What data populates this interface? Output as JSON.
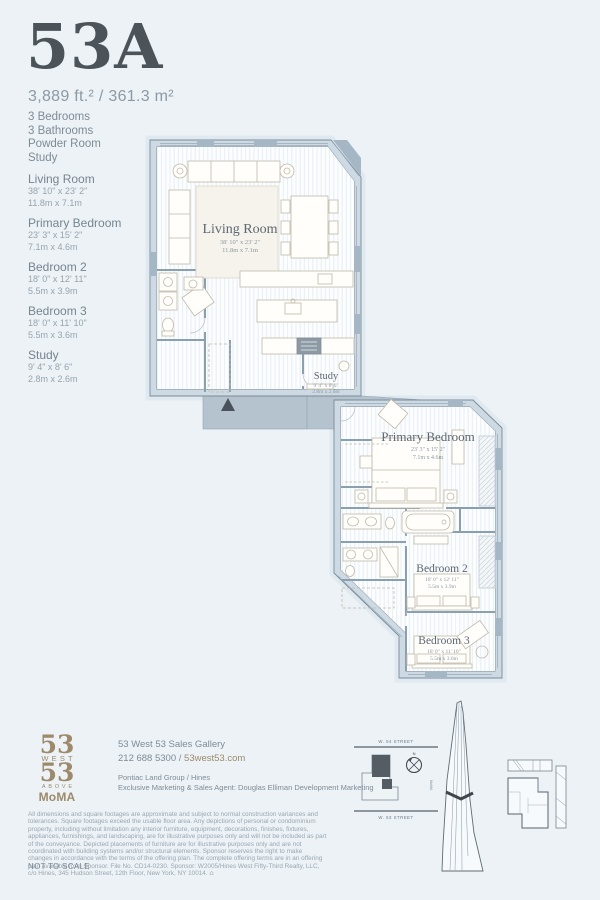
{
  "page": {
    "background": "#ecf2f6"
  },
  "header": {
    "unit_number": "53A",
    "area": "3,889 ft.² / 361.3 m²",
    "features": [
      "3 Bedrooms",
      "3 Bathrooms",
      "Powder Room",
      "Study"
    ]
  },
  "rooms": [
    {
      "name": "Living Room",
      "imperial": "38' 10\" x 23' 2\"",
      "metric": "11.8m x 7.1m"
    },
    {
      "name": "Primary Bedroom",
      "imperial": "23' 3\" x 15' 2\"",
      "metric": "7.1m x 4.6m"
    },
    {
      "name": "Bedroom 2",
      "imperial": "18' 0\" x 12' 11\"",
      "metric": "5.5m x 3.9m"
    },
    {
      "name": "Bedroom 3",
      "imperial": "18' 0\" x 11' 10\"",
      "metric": "5.5m x 3.6m"
    },
    {
      "name": "Study",
      "imperial": "9' 4\" x 8' 6\"",
      "metric": "2.8m x 2.6m"
    }
  ],
  "site_map": {
    "street_top": "W. 54 STREET",
    "street_bottom": "W. 53 STREET",
    "compass_label": "N",
    "east_label": "MoMA"
  },
  "footer": {
    "logo": {
      "top_number": "53",
      "line_west": "WEST",
      "bottom_number": "53",
      "line_above": "ABOVE",
      "line_moma": "MoMA"
    },
    "sales_gallery": "53 West 53 Sales Gallery",
    "phone": "212 688 5300",
    "separator": " / ",
    "website": "53west53.com",
    "developer": "Pontiac Land Group / Hines",
    "agent": "Exclusive Marketing & Sales Agent: Douglas Elliman Development Marketing",
    "disclaimer": "All dimensions and square footages are approximate and subject to normal construction variances and tolerances. Square footages exceed the usable floor area. Any depictions of personal or condominium property, including without limitation any interior furniture, equipment, decorations, finishes, fixtures, appliances, furnishings, and landscaping, are for illustrative purposes only and will not be included as part of the conveyance. Depicted placements of furniture are for illustrative purposes only and are not coordinated with building systems and/or structural elements. Sponsor reserves the right to make changes in accordance with the terms of the offering plan. The complete offering terms are in an offering plan available from Sponsor. File No. CD14-0230. Sponsor: W2005/Hines West Fifty-Third Realty, LLC, c/o Hines, 345 Hudson Street, 12th Floor, New York, NY 10014.",
    "not_to_scale": "NOT TO SCALE"
  },
  "colors": {
    "accent_gold": "#9c8a6a",
    "title": "#4c545a",
    "body_text": "#7e8c96",
    "muted_text": "#98a4ad",
    "wall_fill": "#cdd9e3",
    "context_fill": "#b5c3cf",
    "plan_outline": "#6e7f8d"
  }
}
